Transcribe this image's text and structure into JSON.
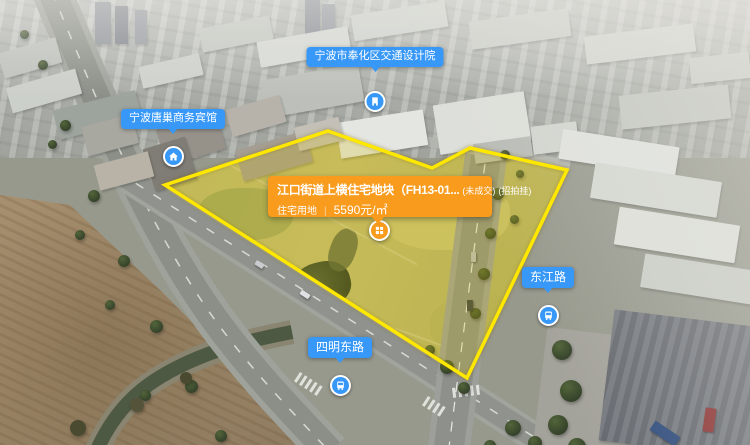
{
  "theme": {
    "orange": "#F99B1D",
    "blue": "#3898F8",
    "outline_yellow": "#FFE800"
  },
  "parcel": {
    "polygon_points": "328,131 432,168 470,148 567,170 467,378 165,185",
    "marker_icon": "grid-building-icon",
    "card": {
      "title": "江口街道上横住宅地块（FH13-01...",
      "status_unsold": "(未成交)",
      "status_listing": "(招拍挂)",
      "land_use": "住宅用地",
      "divider": "|",
      "price": "5590元/㎡"
    }
  },
  "poi": {
    "institute": {
      "label": "宁波市奉化区交通设计院",
      "icon": "building-icon"
    },
    "hotel": {
      "label": "宁波唐巢商务宾馆",
      "icon": "home-icon"
    },
    "dongjiang_road": {
      "label": "东江路",
      "icon": "bus-icon"
    },
    "siming_east_road": {
      "label": "四明东路",
      "icon": "bus-icon"
    }
  }
}
